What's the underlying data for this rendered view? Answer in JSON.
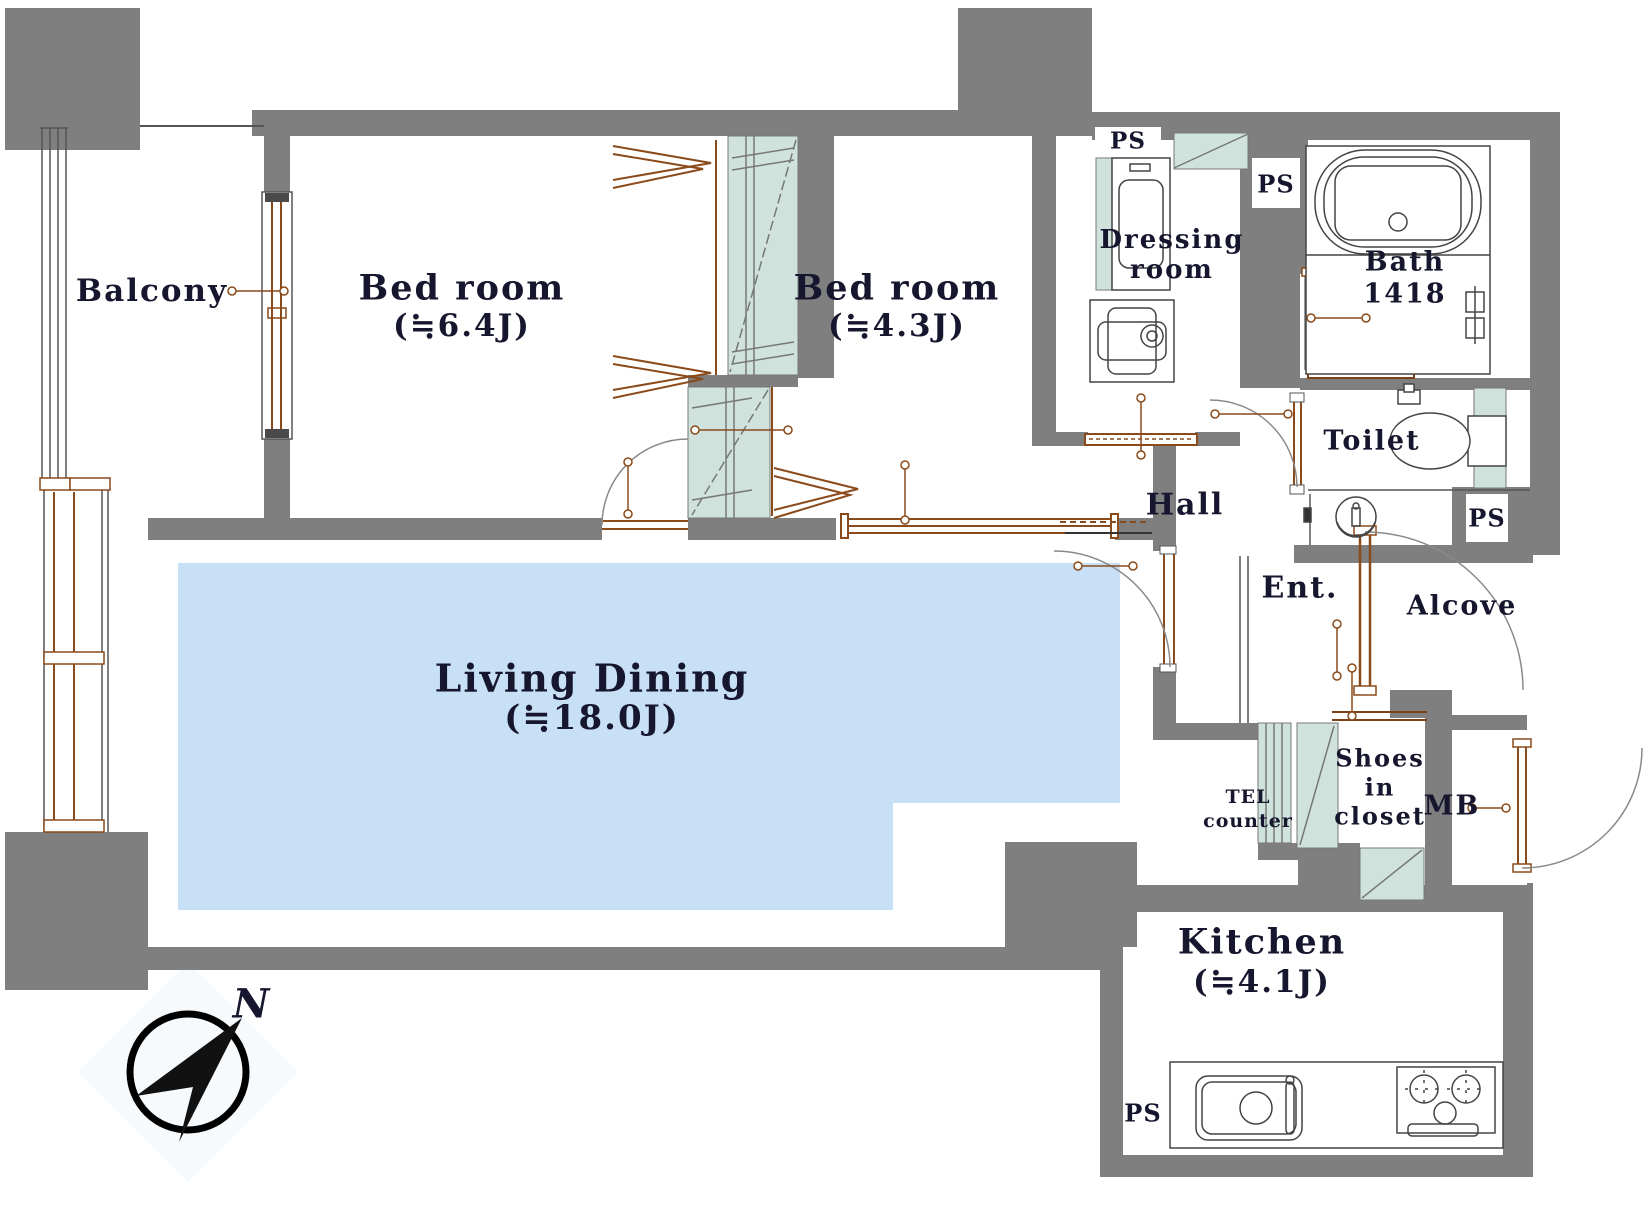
{
  "plan": {
    "type": "apartment-floor-plan",
    "compass": {
      "north_label": "N"
    },
    "colors": {
      "wall": "#7f7f7f",
      "living_floor": "#c8e0f5",
      "closet_fill": "#cfe3dc",
      "fitting_brown": "#8a4a1a",
      "text": "#16162e",
      "compass_diamond": "#f6fafd"
    },
    "rooms": {
      "balcony": {
        "label": "Balcony"
      },
      "bedroom_large": {
        "label": "Bed room",
        "size": "(≒6.4J)"
      },
      "bedroom_small": {
        "label": "Bed room",
        "size": "(≒4.3J)"
      },
      "dressing": {
        "label_line1": "Dressing",
        "label_line2": "room"
      },
      "bath": {
        "label": "Bath",
        "size": "1418"
      },
      "toilet": {
        "label": "Toilet"
      },
      "hall": {
        "label": "Hall"
      },
      "entrance": {
        "label": "Ent."
      },
      "alcove": {
        "label": "Alcove"
      },
      "shoes_closet": {
        "label_line1": "Shoes",
        "label_line2": "in",
        "label_line3": "closet"
      },
      "tel_counter": {
        "label_line1": "TEL",
        "label_line2": "counter"
      },
      "meter_box": {
        "label": "MB"
      },
      "living_dining": {
        "label": "Living Dining",
        "size": "(≒18.0J)"
      },
      "kitchen": {
        "label": "Kitchen",
        "size": "(≒4.1J)"
      }
    },
    "shafts": {
      "ps": "PS"
    }
  }
}
